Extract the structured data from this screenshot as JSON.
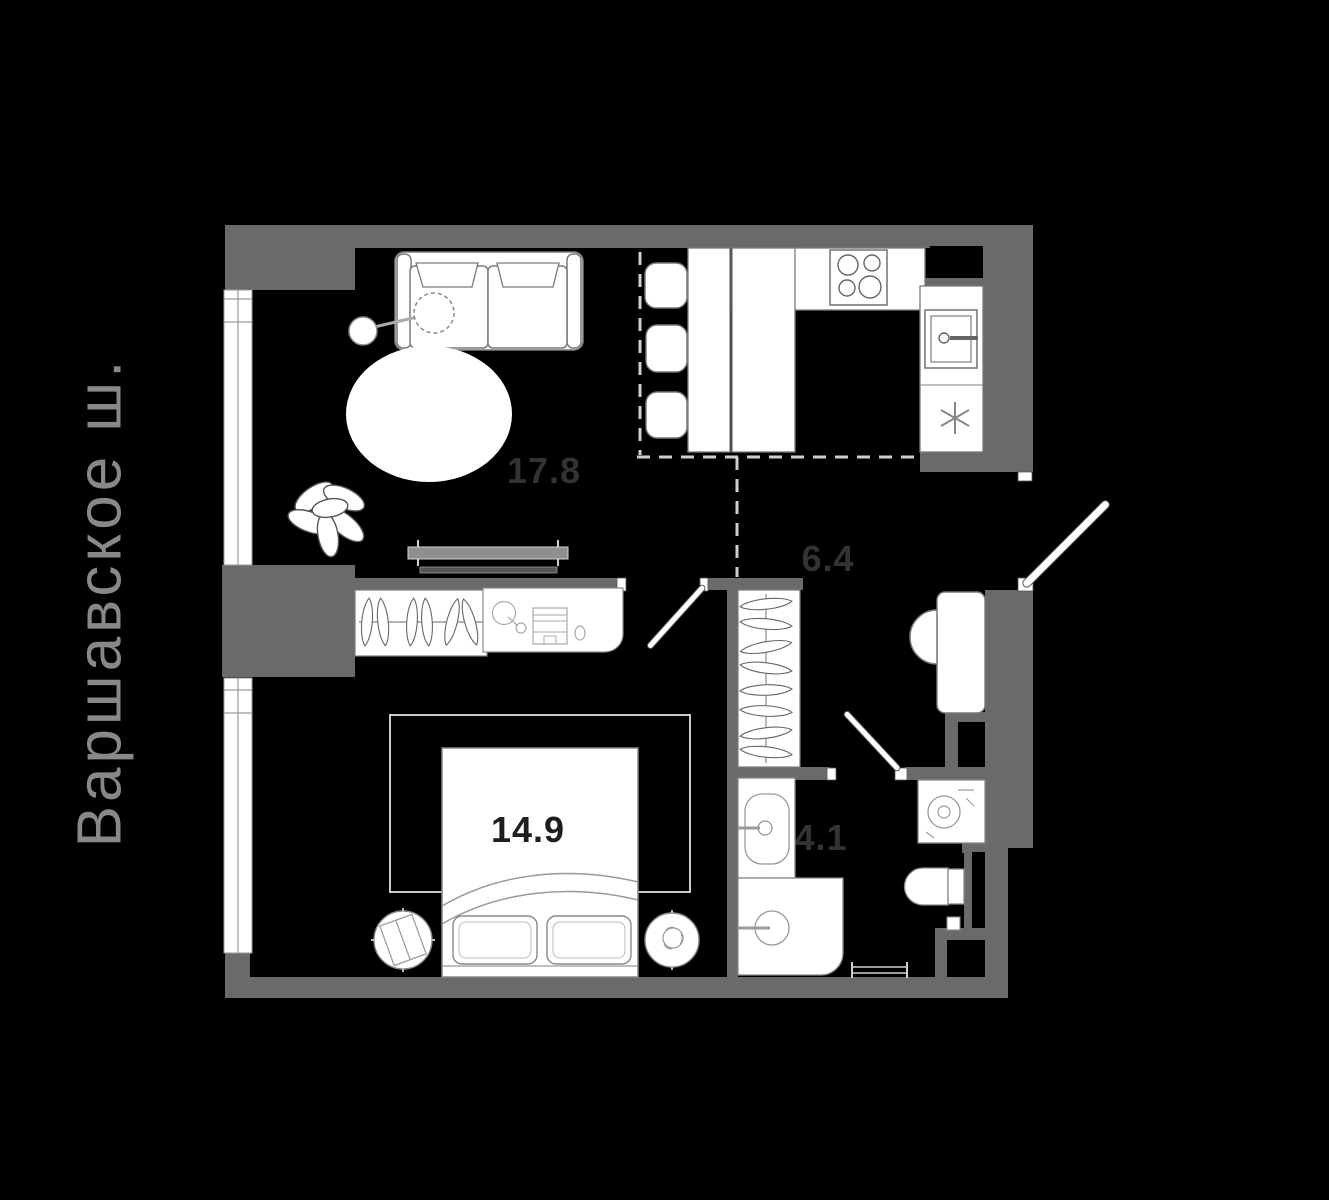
{
  "street_label": {
    "text": "Варшавское ш."
  },
  "plan": {
    "rooms": [
      {
        "id": "living-room",
        "area_label": "17.8"
      },
      {
        "id": "hallway",
        "area_label": "6.4"
      },
      {
        "id": "bedroom",
        "area_label": "14.9"
      },
      {
        "id": "bathroom",
        "area_label": "4.1"
      }
    ],
    "colors": {
      "background": "#000000",
      "wall": "#6a6a6a",
      "furniture_fill": "#ffffff",
      "furniture_stroke": "#777777",
      "room_label": "#333333",
      "room_label_on_white": "#1e1e1e",
      "street_label": "#888888",
      "dashed_zone": "#cfcfcf"
    },
    "furniture_icons": [
      "sofa-icon",
      "floor-lamp-icon",
      "round-rug-icon",
      "plant-icon",
      "tv-stand-icon",
      "dining-table-icon",
      "chair-icon",
      "stove-icon",
      "kitchen-sink-icon",
      "fridge-icon",
      "wardrobe-icon",
      "dressing-table-icon",
      "rug-icon",
      "double-bed-icon",
      "nightstand-icon",
      "hallway-wardrobe-icon",
      "desk-icon",
      "office-chair-icon",
      "entrance-door-icon",
      "interior-door-icon",
      "bathroom-sink-icon",
      "shower-icon",
      "washing-machine-icon",
      "toilet-icon",
      "towel-rail-icon",
      "window-icon"
    ]
  }
}
